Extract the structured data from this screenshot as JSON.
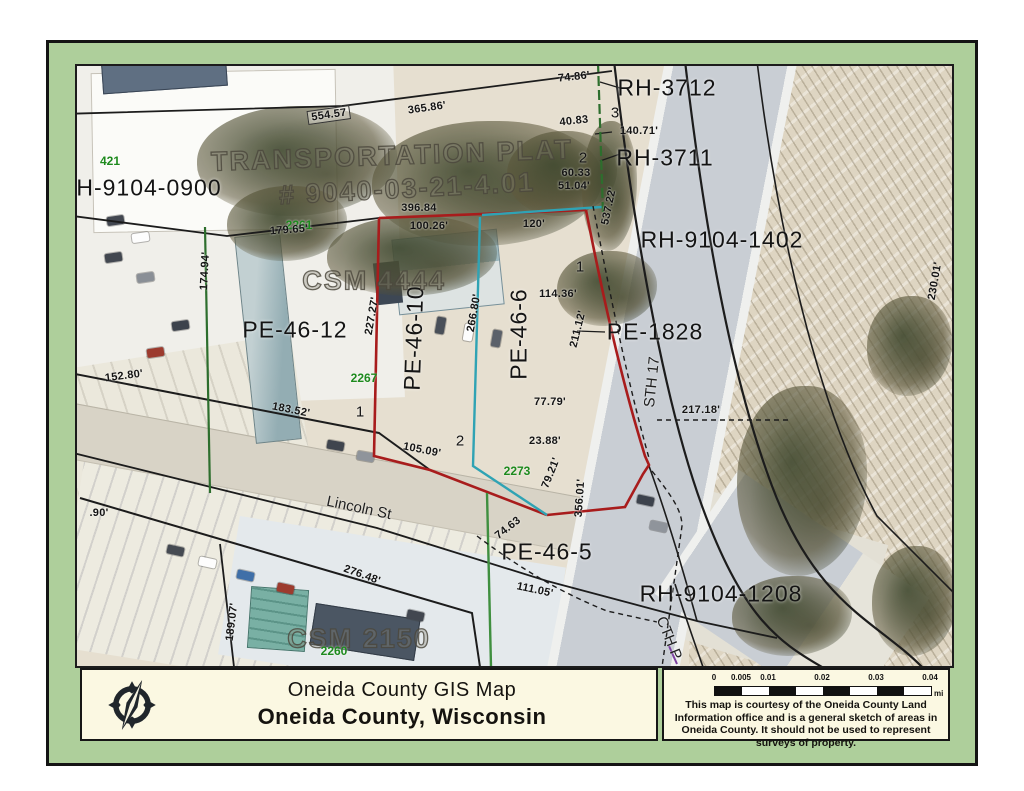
{
  "document_title": "Oneida County GIS Map",
  "colors": {
    "frame_green": "#aecf9b",
    "boundary_red": "#a81c1c",
    "boundary_teal": "#2fa3b4",
    "boundary_green": "#3f8f3f",
    "boundary_dark_green": "#2d6e2d",
    "address_green": "#1d8a1d",
    "panel_cream": "#fbf8e2",
    "highway_gray": "#c9ced4"
  },
  "footer": {
    "title_line1": "Oneida County GIS Map",
    "title_line2": "Oneida County, Wisconsin",
    "logo": "compass-rose",
    "scale": {
      "ticks": [
        {
          "label": "0",
          "f": 0
        },
        {
          "label": "0.005",
          "f": 0.125
        },
        {
          "label": "0.01",
          "f": 0.25
        },
        {
          "label": "0.02",
          "f": 0.5
        },
        {
          "label": "0.03",
          "f": 0.75
        },
        {
          "label": "0.04",
          "f": 1
        }
      ],
      "unit": "mi"
    },
    "disclaimer": "This map is courtesy of the Oneida County Land Information office and is a general sketch of areas in Oneida County.  It should not be used to represent surveys of property."
  },
  "map": {
    "labels": [
      {
        "t": "RH-3712",
        "x": 590,
        "y": 22,
        "r": 0,
        "k": "pid"
      },
      {
        "t": "RH-3711",
        "x": 588,
        "y": 92,
        "r": 0,
        "k": "pid"
      },
      {
        "t": "RH-9104-1402",
        "x": 645,
        "y": 174,
        "r": 0,
        "k": "pid"
      },
      {
        "t": "PE-1828",
        "x": 578,
        "y": 266,
        "r": 0,
        "k": "pid"
      },
      {
        "t": "PE-46-12",
        "x": 218,
        "y": 264,
        "r": 0,
        "k": "pid"
      },
      {
        "t": "PE-46-10",
        "x": 337,
        "y": 272,
        "r": -88,
        "k": "pid"
      },
      {
        "t": "PE-46-6",
        "x": 442,
        "y": 268,
        "r": -90,
        "k": "pid"
      },
      {
        "t": "PE-46-5",
        "x": 470,
        "y": 486,
        "r": 0,
        "k": "pid"
      },
      {
        "t": "RH-9104-1208",
        "x": 644,
        "y": 528,
        "r": 0,
        "k": "pid"
      },
      {
        "t": "H-9104-0900",
        "x": 72,
        "y": 122,
        "r": 0,
        "k": "pid"
      },
      {
        "t": "TRANSPORTATION PLAT",
        "x": 315,
        "y": 90,
        "r": -2,
        "k": "survey"
      },
      {
        "t": "# 9040-03-21-4.01",
        "x": 330,
        "y": 123,
        "r": -3,
        "k": "survey"
      },
      {
        "t": "CSM 4444",
        "x": 297,
        "y": 215,
        "r": 0,
        "k": "survey"
      },
      {
        "t": "CSM 2150",
        "x": 282,
        "y": 573,
        "r": 0,
        "k": "survey"
      },
      {
        "t": "Lincoln St",
        "x": 282,
        "y": 442,
        "r": 12,
        "k": "road"
      },
      {
        "t": "STH 17",
        "x": 575,
        "y": 316,
        "r": -84,
        "k": "road"
      },
      {
        "t": "CTH P",
        "x": 592,
        "y": 572,
        "r": 68,
        "k": "road"
      },
      {
        "t": "421",
        "x": 33,
        "y": 95,
        "r": 0,
        "k": "addr"
      },
      {
        "t": "2261",
        "x": 222,
        "y": 159,
        "r": 0,
        "k": "addr"
      },
      {
        "t": "2267",
        "x": 287,
        "y": 312,
        "r": 0,
        "k": "addr"
      },
      {
        "t": "2273",
        "x": 440,
        "y": 405,
        "r": 0,
        "k": "addr"
      },
      {
        "t": "2260",
        "x": 257,
        "y": 585,
        "r": 0,
        "k": "addr"
      },
      {
        "t": "554.57",
        "x": 252,
        "y": 49,
        "r": -8,
        "k": "m",
        "b": true
      },
      {
        "t": "365.86'",
        "x": 350,
        "y": 42,
        "r": -8,
        "k": "m"
      },
      {
        "t": "74.86'",
        "x": 497,
        "y": 11,
        "r": -6,
        "k": "m"
      },
      {
        "t": "40.83",
        "x": 497,
        "y": 55,
        "r": -6,
        "k": "m"
      },
      {
        "t": "140.71'",
        "x": 562,
        "y": 65,
        "r": 0,
        "k": "m"
      },
      {
        "t": "60.33",
        "x": 499,
        "y": 107,
        "r": 0,
        "k": "m"
      },
      {
        "t": "51.04'",
        "x": 497,
        "y": 120,
        "r": 0,
        "k": "m"
      },
      {
        "t": "537.22'",
        "x": 532,
        "y": 140,
        "r": -78,
        "k": "m"
      },
      {
        "t": "396.84",
        "x": 342,
        "y": 142,
        "r": 0,
        "k": "m"
      },
      {
        "t": "100.26'",
        "x": 352,
        "y": 160,
        "r": 0,
        "k": "m"
      },
      {
        "t": "120'",
        "x": 457,
        "y": 158,
        "r": 0,
        "k": "m"
      },
      {
        "t": "179.65'",
        "x": 212,
        "y": 164,
        "r": -4,
        "k": "m"
      },
      {
        "t": "174.94'",
        "x": 128,
        "y": 205,
        "r": -87,
        "k": "m"
      },
      {
        "t": "227.27'",
        "x": 295,
        "y": 250,
        "r": -80,
        "k": "m"
      },
      {
        "t": "266.80'",
        "x": 397,
        "y": 247,
        "r": -80,
        "k": "m"
      },
      {
        "t": "114.36'",
        "x": 481,
        "y": 228,
        "r": 0,
        "k": "m"
      },
      {
        "t": "211.12'",
        "x": 501,
        "y": 263,
        "r": -76,
        "k": "m"
      },
      {
        "t": "152.80'",
        "x": 47,
        "y": 310,
        "r": -7,
        "k": "m"
      },
      {
        "t": "183.52'",
        "x": 214,
        "y": 344,
        "r": 11,
        "k": "m"
      },
      {
        "t": "105.09'",
        "x": 345,
        "y": 384,
        "r": 11,
        "k": "m"
      },
      {
        "t": "77.79'",
        "x": 473,
        "y": 336,
        "r": 0,
        "k": "m"
      },
      {
        "t": "23.88'",
        "x": 468,
        "y": 375,
        "r": 0,
        "k": "m"
      },
      {
        "t": "79.21'",
        "x": 474,
        "y": 407,
        "r": -68,
        "k": "m"
      },
      {
        "t": "356.01'",
        "x": 503,
        "y": 432,
        "r": -86,
        "k": "m"
      },
      {
        "t": "74.63",
        "x": 431,
        "y": 462,
        "r": -38,
        "k": "m"
      },
      {
        "t": "217.18'",
        "x": 624,
        "y": 344,
        "r": 0,
        "k": "m"
      },
      {
        "t": "111.05'",
        "x": 458,
        "y": 524,
        "r": 12,
        "k": "m"
      },
      {
        "t": "276.48'",
        "x": 285,
        "y": 509,
        "r": 20,
        "k": "m"
      },
      {
        "t": ".90'",
        "x": 22,
        "y": 447,
        "r": 0,
        "k": "m"
      },
      {
        "t": "189.07'",
        "x": 155,
        "y": 556,
        "r": -83,
        "k": "m"
      },
      {
        "t": "230.01'",
        "x": 858,
        "y": 215,
        "r": -80,
        "k": "m"
      },
      {
        "t": "3",
        "x": 538,
        "y": 47,
        "r": 0,
        "k": "lot"
      },
      {
        "t": "2",
        "x": 506,
        "y": 92,
        "r": 0,
        "k": "lot"
      },
      {
        "t": "1",
        "x": 503,
        "y": 201,
        "r": 0,
        "k": "lot"
      },
      {
        "t": "1",
        "x": 283,
        "y": 346,
        "r": 0,
        "k": "lot"
      },
      {
        "t": "2",
        "x": 383,
        "y": 375,
        "r": 0,
        "k": "lot"
      }
    ]
  }
}
